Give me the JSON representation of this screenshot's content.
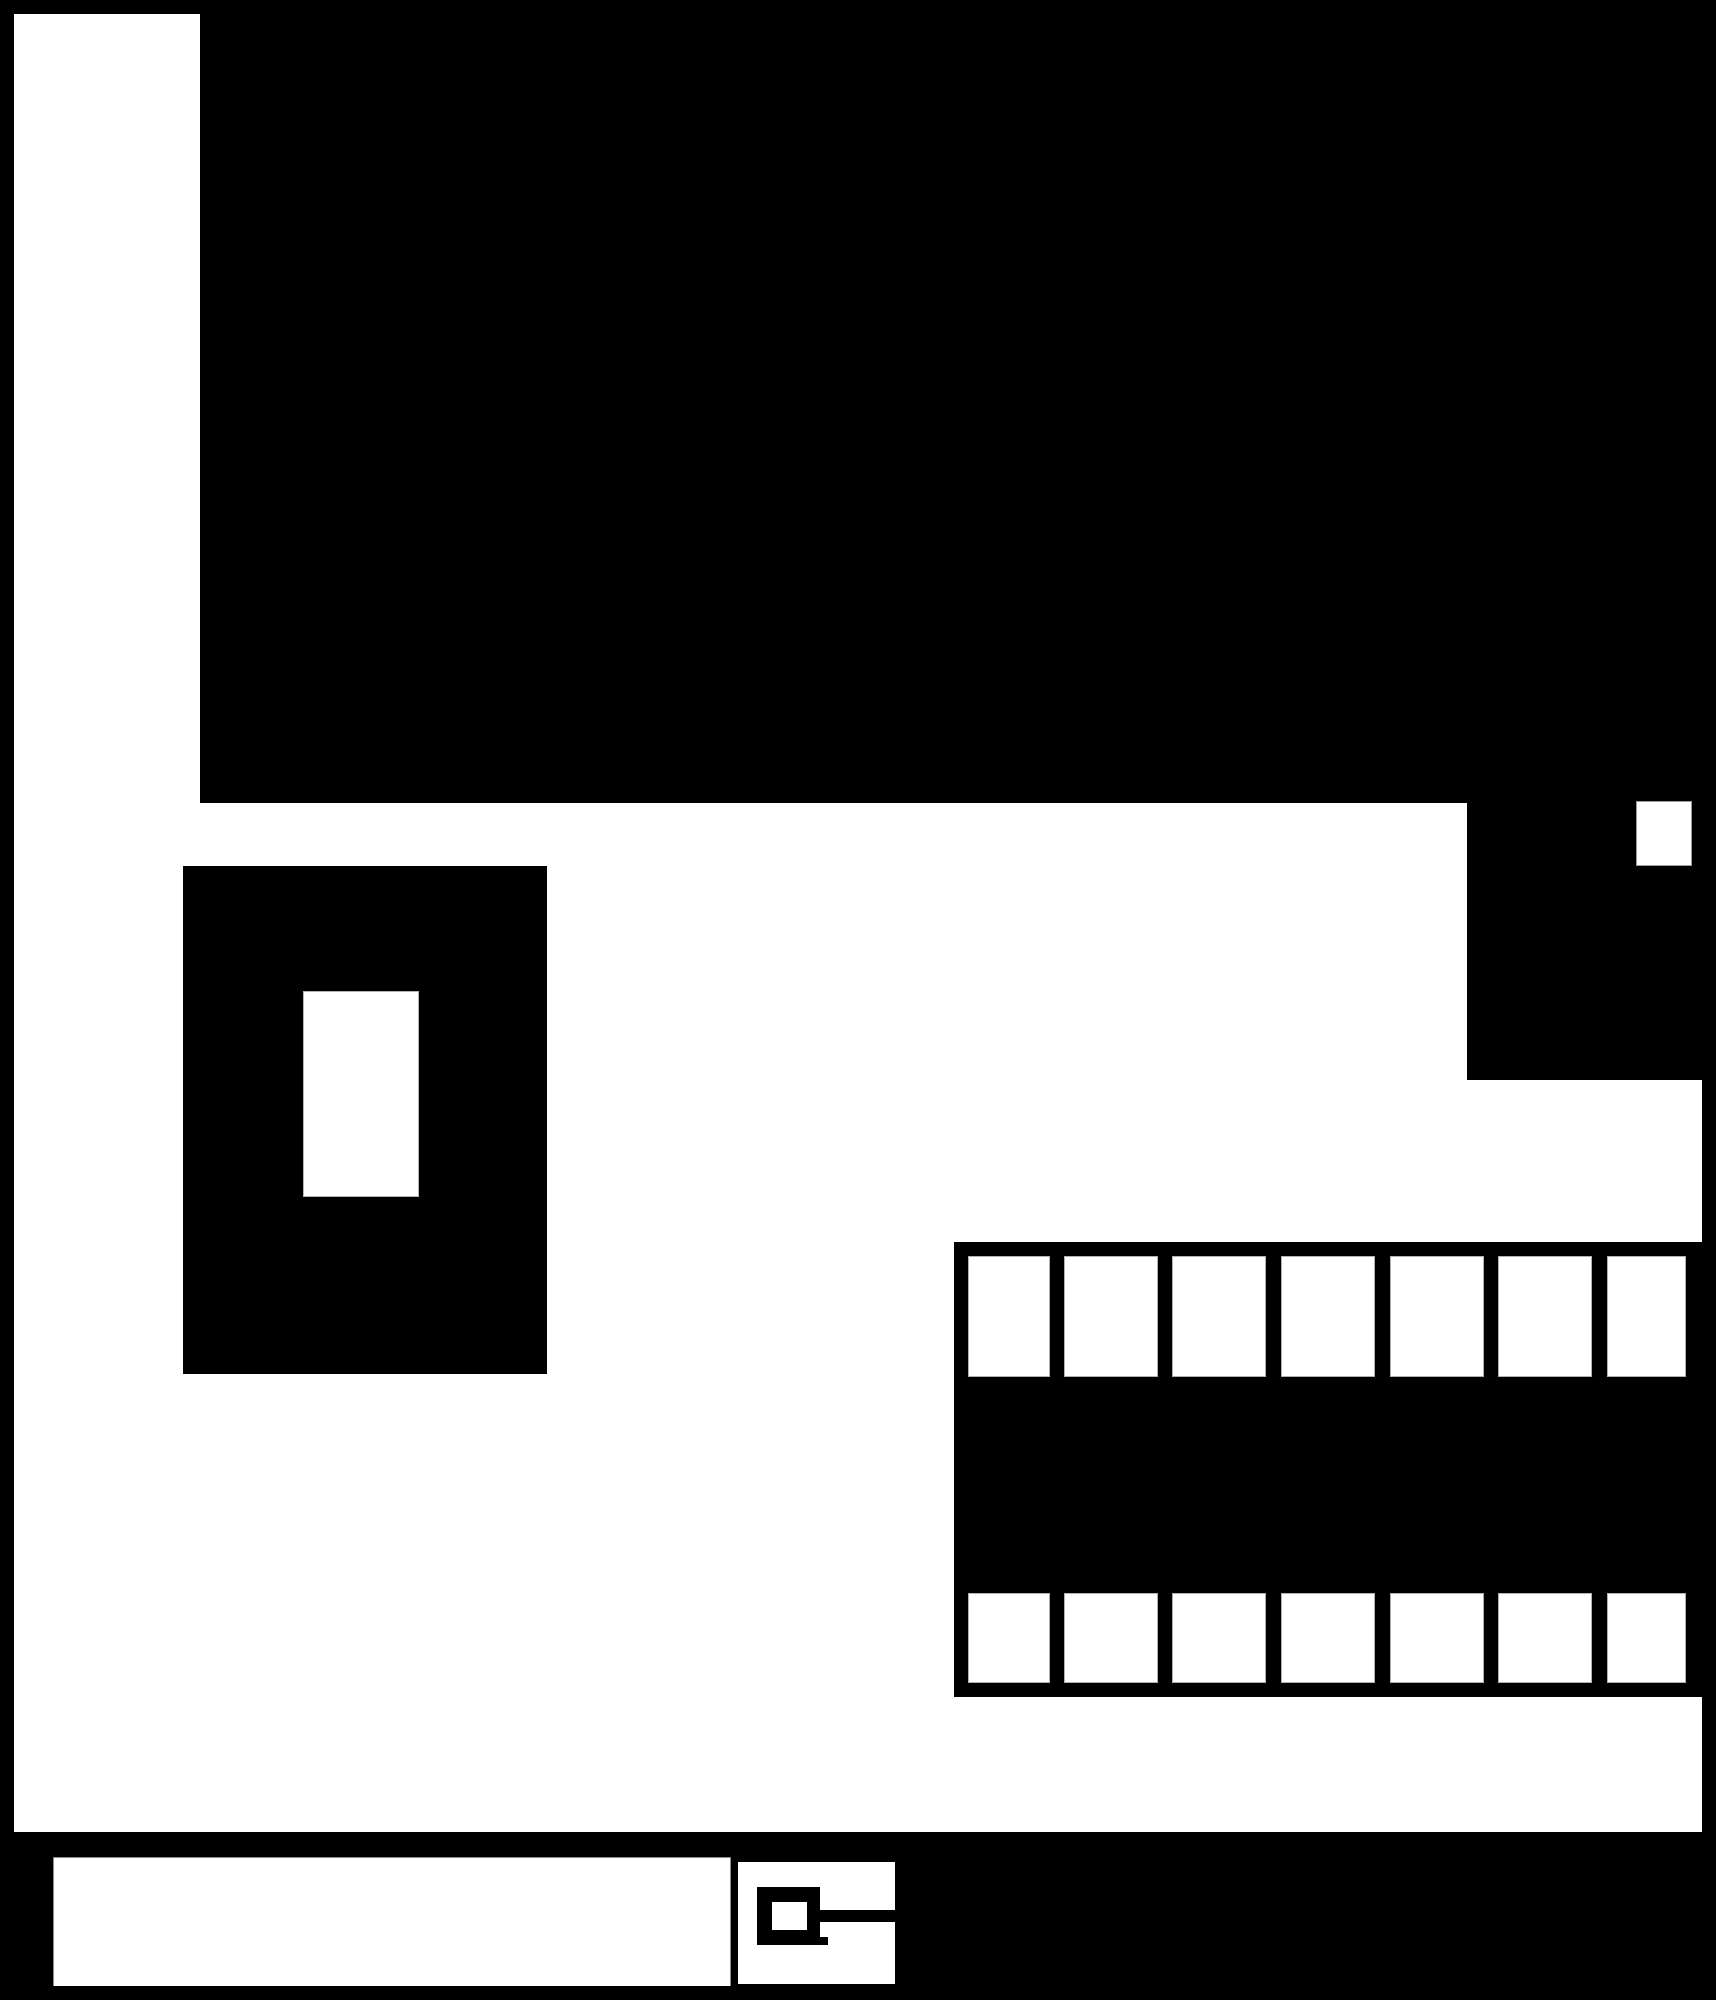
{
  "canvas": {
    "width": 1716,
    "height": 2000,
    "background_color": "#ffffff",
    "ink_color": "#000000",
    "hairline_color": "#9a9a9a"
  },
  "frame": {
    "top": {
      "x": 0,
      "y": 0,
      "w": 1716,
      "h": 14,
      "color": "#000000"
    },
    "left": {
      "x": 0,
      "y": 0,
      "w": 14,
      "h": 2000,
      "color": "#000000"
    },
    "right": {
      "x": 1702,
      "y": 0,
      "w": 14,
      "h": 2000,
      "color": "#000000"
    },
    "bottom": {
      "x": 0,
      "y": 1986,
      "w": 1716,
      "h": 14,
      "color": "#000000"
    }
  },
  "regions": {
    "main_canvas": {
      "x": 14,
      "y": 14,
      "w": 1688,
      "h": 1818,
      "color": "#ffffff"
    },
    "sidebar_panel": {
      "x": 14,
      "y": 14,
      "w": 186,
      "h": 1818,
      "color": "#ffffff"
    },
    "content_panel": {
      "x": 200,
      "y": 14,
      "w": 1516,
      "h": 789,
      "color": "#000000"
    },
    "right_rail": {
      "x": 1467,
      "y": 803,
      "w": 249,
      "h": 277,
      "color": "#000000"
    },
    "rail_tile": {
      "x": 1636,
      "y": 801,
      "w": 56,
      "h": 65,
      "color": "#ffffff",
      "border_color": "#9a9a9a"
    },
    "dialog_overlay": {
      "x": 183,
      "y": 866,
      "w": 364,
      "h": 508,
      "color": "#000000"
    },
    "dialog_inner": {
      "x": 303,
      "y": 991,
      "w": 116,
      "h": 206,
      "color": "#ffffff",
      "border_color": "#b5b5b5"
    },
    "taskbar": {
      "x": 0,
      "y": 1832,
      "w": 1716,
      "h": 168,
      "color": "#000000"
    },
    "search_box": {
      "x": 53,
      "y": 1857,
      "w": 678,
      "h": 132,
      "color": "#ffffff",
      "border_color": "#8a8a8a"
    },
    "icon_panel": {
      "x": 738,
      "y": 1862,
      "w": 157,
      "h": 122,
      "color": "#ffffff"
    }
  },
  "filmstrip": {
    "panel": {
      "x": 954,
      "y": 1242,
      "w": 762,
      "h": 455,
      "color": "#000000"
    },
    "columns": 7,
    "row_count": 2,
    "cell_lefts": [
      14,
      110,
      218,
      327,
      436,
      544,
      653
    ],
    "cell_widths": [
      82,
      94,
      94,
      94,
      94,
      94,
      79
    ],
    "rows": [
      {
        "top": 14,
        "height": 121
      },
      {
        "top": 351,
        "height": 90
      }
    ],
    "cell_color": "#ffffff",
    "cell_border_color": "#b0b0b0"
  },
  "key_icon": {
    "ring": {
      "x": 19,
      "y": 25,
      "w": 63,
      "h": 58,
      "color": "#000000"
    },
    "hole": {
      "x": 34,
      "y": 40,
      "w": 35,
      "h": 28,
      "color": "#ffffff"
    },
    "bar": {
      "x": 82,
      "y": 48,
      "w": 75,
      "h": 12,
      "color": "#000000"
    },
    "notch": {
      "x": 72,
      "y": 75,
      "w": 18,
      "h": 8,
      "color": "#000000"
    }
  }
}
